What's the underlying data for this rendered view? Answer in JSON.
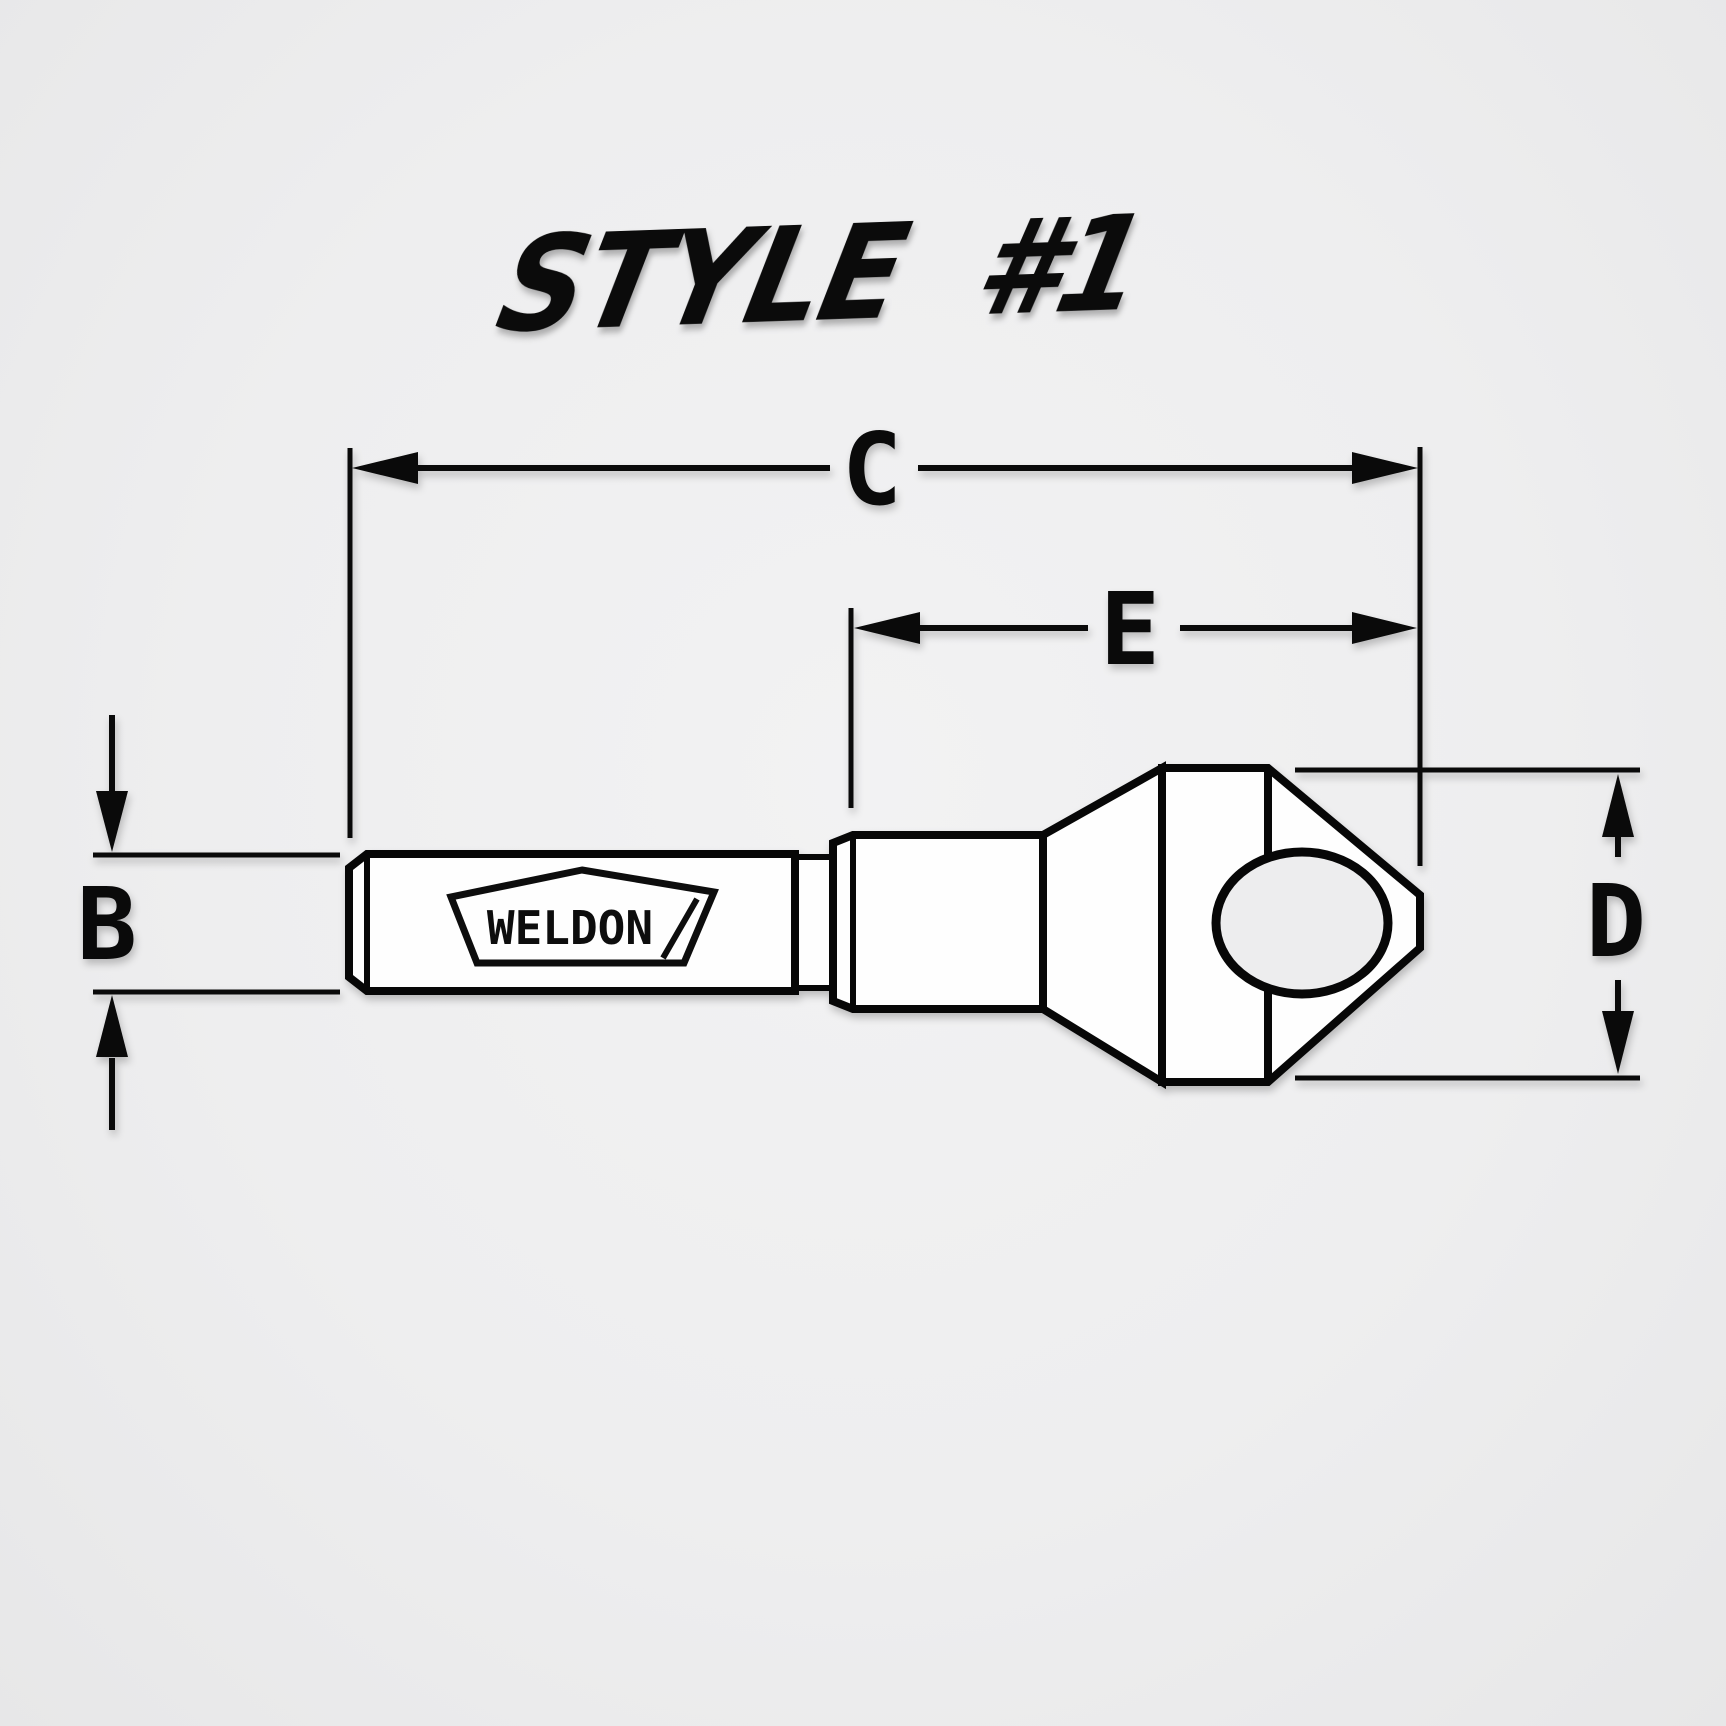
{
  "title": "STYLE #1",
  "logo": {
    "brand": "WELDON"
  },
  "dimensions": {
    "b": "B",
    "c": "C",
    "d": "D",
    "e": "E"
  },
  "colors": {
    "background": "#eeeeef",
    "line": "#0a0a0a",
    "tool_fill": "#fefefe",
    "hole_fill": "#ededee"
  }
}
